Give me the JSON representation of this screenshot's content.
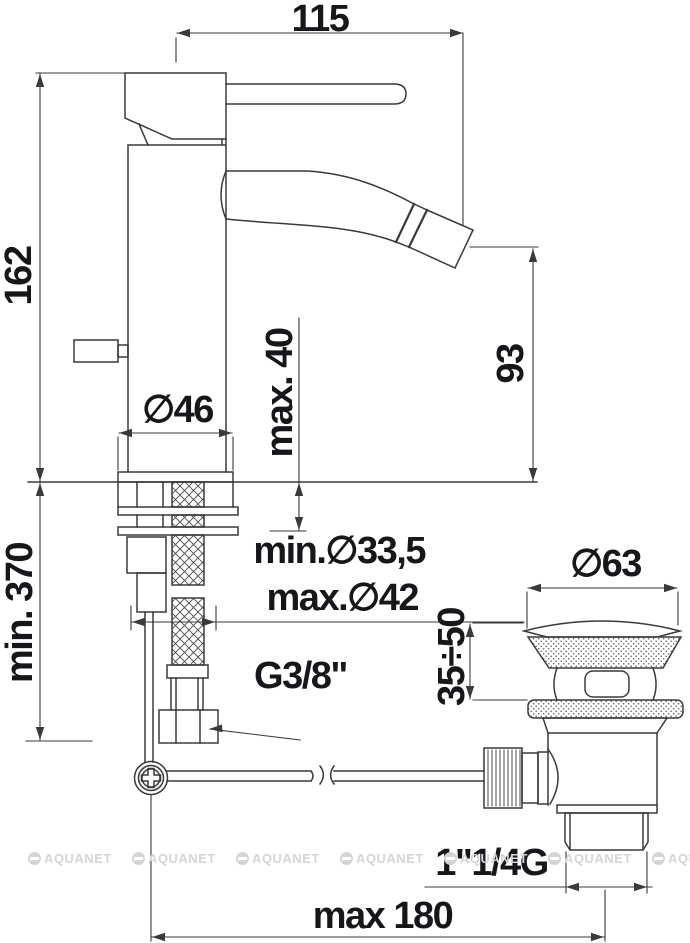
{
  "drawing_title": "bidet mixer technical dimension drawing",
  "colors": {
    "line": "#3a3a3a",
    "text": "#17171b",
    "background": "#ffffff",
    "watermark": "#d5d5d8",
    "hatch": "#4a4a4a",
    "stipple": "#5a5a5a"
  },
  "labels": {
    "d115": "115",
    "d162": "162",
    "d370": "min. 370",
    "d40": "max. 40",
    "d93": "93",
    "d46": "∅46",
    "d335": "min.∅33,5",
    "d42": "max.∅42",
    "g38": "G3/8\"",
    "d63": "∅63",
    "d3550": "35÷50",
    "g114": "1\"1/4G",
    "d180": "max 180"
  },
  "watermark": {
    "text": "AQUANET",
    "count": 7
  }
}
